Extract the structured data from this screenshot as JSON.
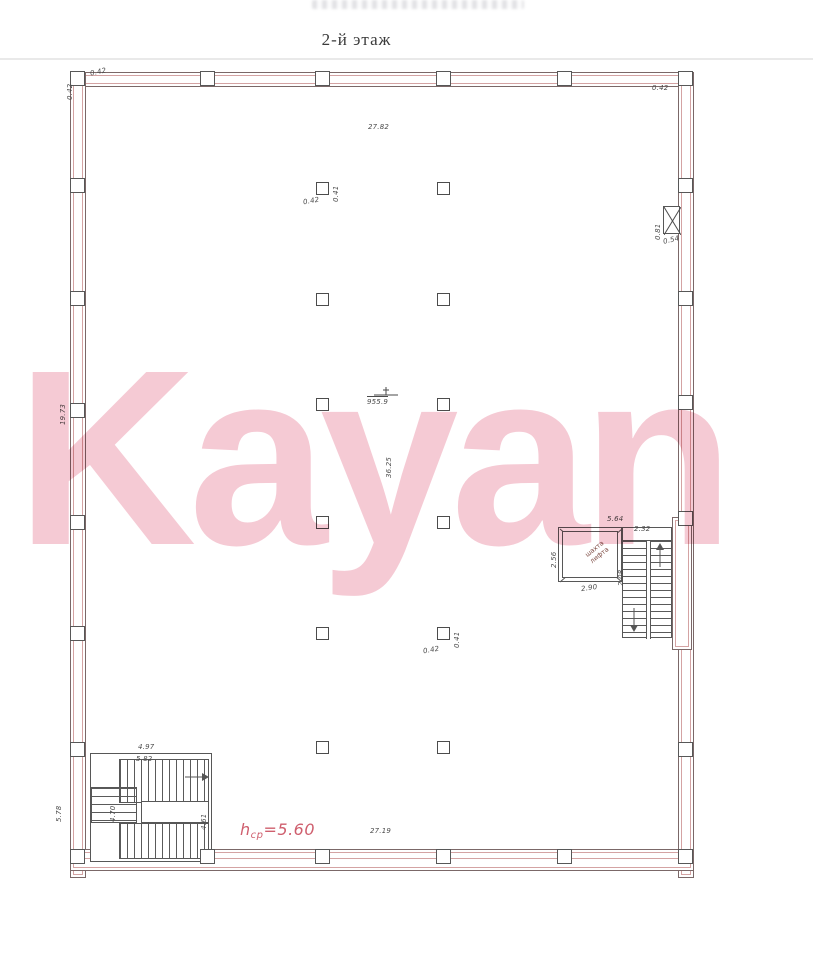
{
  "title": "2-й этаж",
  "watermark": "Kayan",
  "colors": {
    "watermark_pink": "#f3bdca",
    "wall_red": "#d4a3a3",
    "line_dark": "#575757",
    "note_red": "#cf5f6e"
  },
  "labels": {
    "top_width": "27.82",
    "corner_left_a": "0.42",
    "corner_left_b": "0.42",
    "corner_right": "0.42",
    "left_wall_height": "19.73",
    "col_top_w": "0.41",
    "col_top_t": "0.42",
    "area": "955.9",
    "hall_depth": "36.25",
    "col_bot_w": "0.41",
    "col_bot_t": "0.42",
    "duct_h": "0.81",
    "duct_w": "0.54",
    "lift_width_top": "5.64",
    "lift_height_left": "2.56",
    "lift_width_bottom": "2.90",
    "lift_name_1": "шахта",
    "lift_name_2": "лифта",
    "stair_right_width": "2.32",
    "stair_right_flight": "2.08",
    "stair_left_width": "4.97",
    "stair_left_width2": "5.82",
    "stair_left_flight_l": "4.70",
    "stair_left_flight_r": "4.61",
    "stair_left_wall": "5.78",
    "bottom_width": "27.19",
    "height_note_prefix": "h",
    "height_note_sub": "ср",
    "height_note_value": "=5.60"
  }
}
